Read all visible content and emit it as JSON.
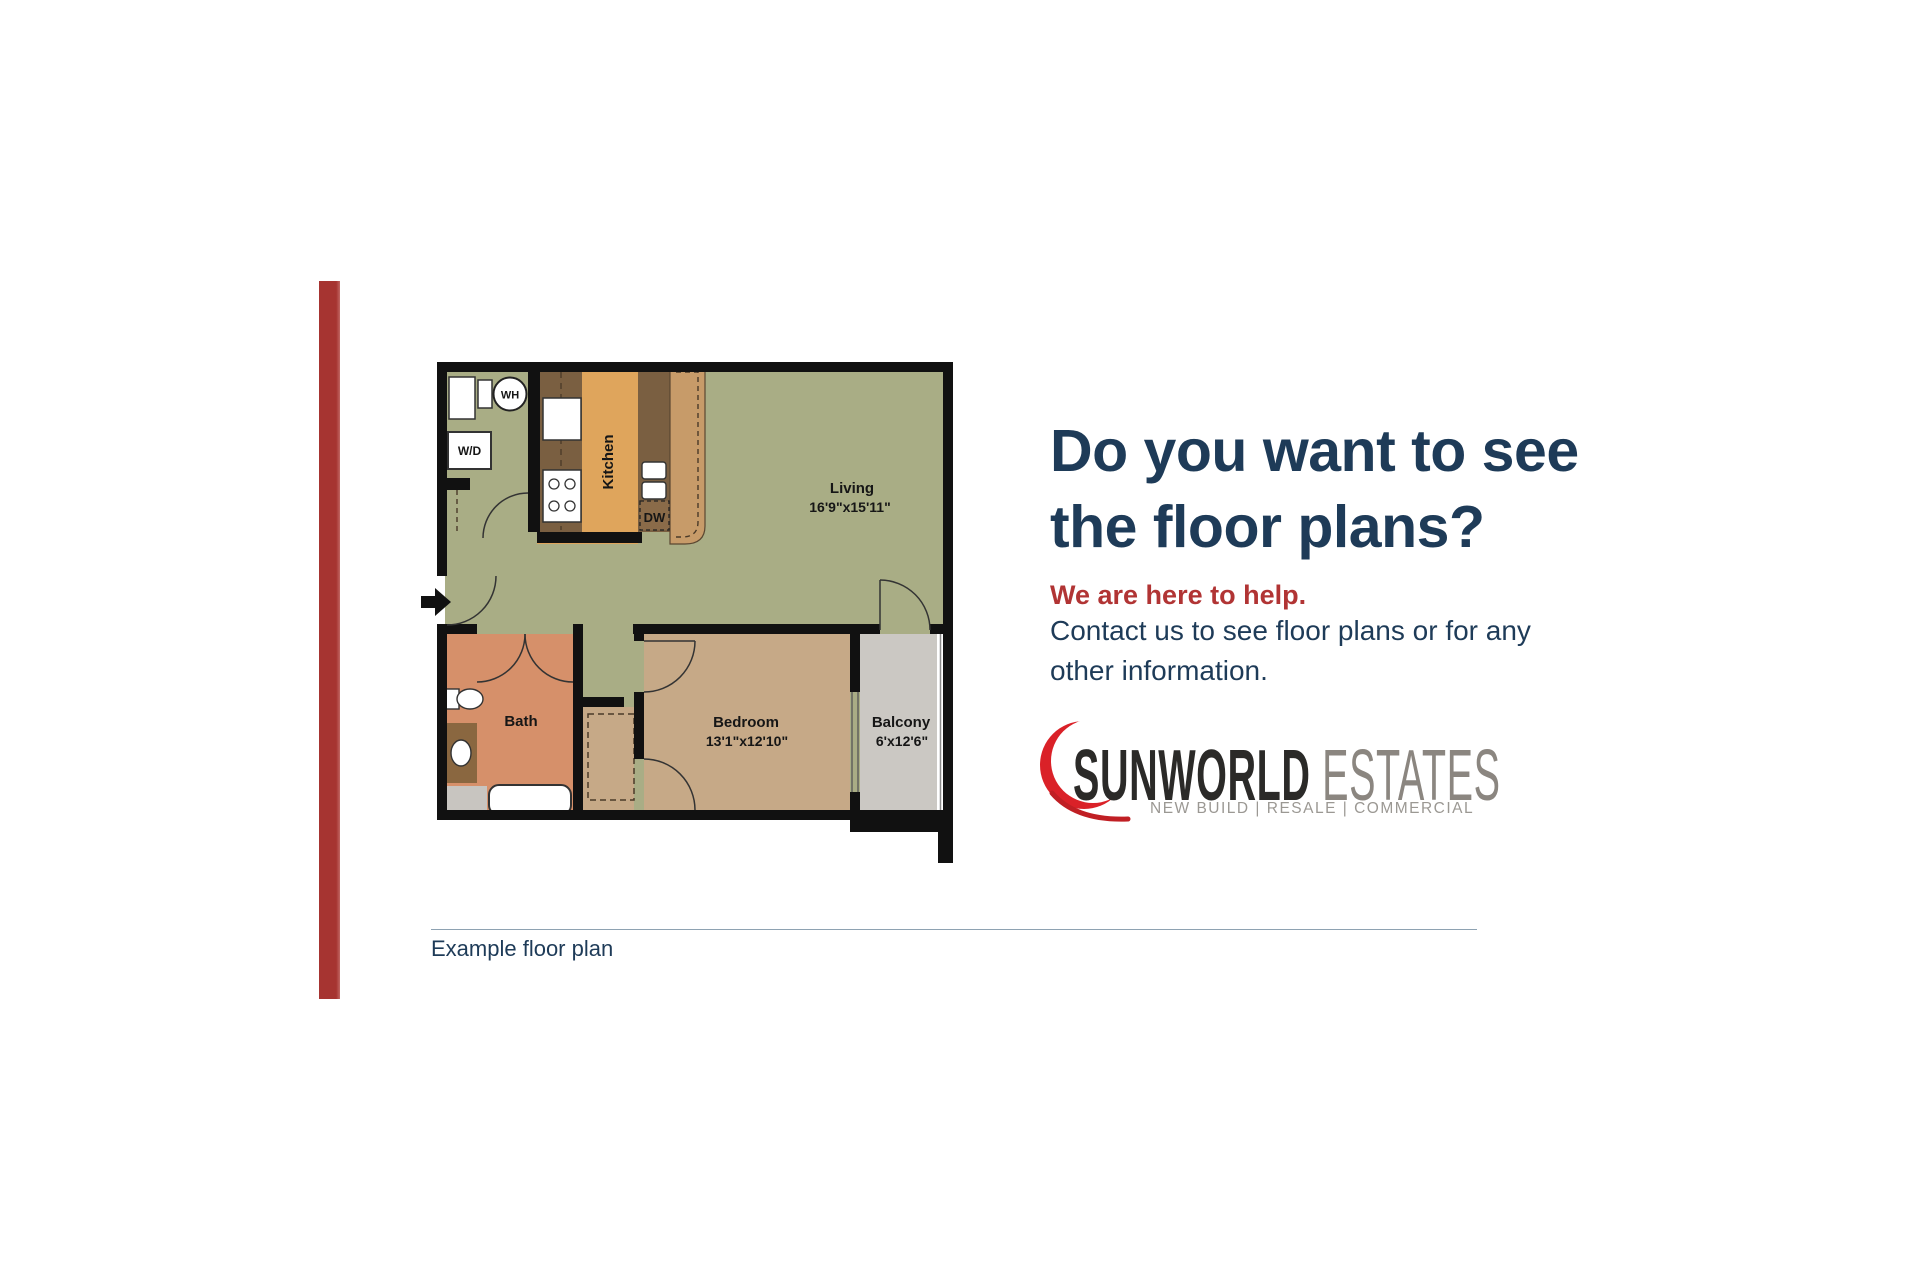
{
  "headline": {
    "line1": "Do you want to see",
    "line2": "the floor plans?",
    "color": "#1e3b58"
  },
  "subheadline": {
    "text": "We are here to help.",
    "color": "#b13434"
  },
  "body": {
    "line1": "Contact us to see floor plans or for any",
    "line2": "other information."
  },
  "logo": {
    "primary": "SUNWORLD",
    "secondary": "ESTATES",
    "tagline": "NEW BUILD | RESALE | COMMERCIAL",
    "mark": "red-crescent-swoosh",
    "mark_color": "#da2128",
    "primary_color": "#2b2a28",
    "secondary_color": "#8b8680"
  },
  "caption": {
    "text": "Example floor plan"
  },
  "accent_bar_color": "#a63431",
  "floor_plan": {
    "living": {
      "name": "Living",
      "dims": "16'9\"x15'11\""
    },
    "bedroom": {
      "name": "Bedroom",
      "dims": "13'1\"x12'10\""
    },
    "balcony": {
      "name": "Balcony",
      "dims": "6'x12'6\""
    },
    "bath": {
      "name": "Bath"
    },
    "kitchen": {
      "name": "Kitchen"
    },
    "appliances": {
      "washer_dryer": "W/D",
      "water_heater": "WH",
      "dishwasher": "DW"
    },
    "colors": {
      "living_floor": "#a9ad85",
      "kitchen_floor": "#dfa55c",
      "counter_dark": "#7a5f41",
      "counter_light": "#c79b69",
      "bedroom_floor": "#c6a987",
      "bath_floor": "#d6906a",
      "balcony_floor": "#cbc8c3",
      "vanity": "#8a6740",
      "walls": "#111111"
    }
  }
}
